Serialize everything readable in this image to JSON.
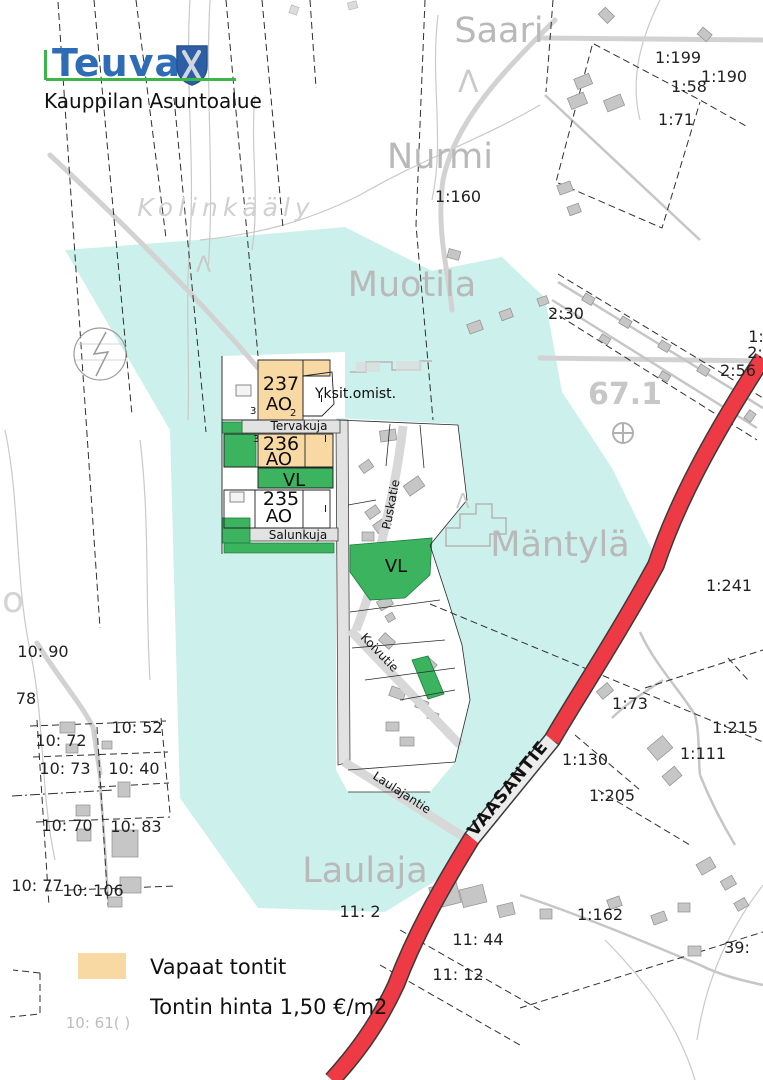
{
  "colors": {
    "highlight_cyan": "#ccf0ec",
    "vacant_orange": "#f8d9a4",
    "park_green": "#3cb45f",
    "road_red": "#ed3a44",
    "logo_blue": "#2e6db6",
    "logo_green": "#3db54a"
  },
  "header": {
    "municipality": "Teuva",
    "title": "Kauppilan Asuntoalue"
  },
  "legend": {
    "vacant_label": "Vapaat tontit",
    "price_label": "Tontin hinta 1,50 €/m2"
  },
  "map": {
    "places": {
      "saari": "Saari",
      "nurmi": "Nurmi",
      "kolinkaaly": "Kolinkääly",
      "muotila": "Muotila",
      "mantyla": "Mäntylä",
      "laulaja": "Laulaja",
      "block_67": "67.1",
      "letter_o": "o"
    },
    "symbols": {
      "lambda": "Λ"
    },
    "streets": {
      "tervakuja": "Tervakuja",
      "salunkuja": "Salunkuja",
      "puskatie": "Puskatie",
      "koivutie": "Koivutie",
      "laulajantie": "Laulajantie",
      "vaasantie": "VAASANTIE"
    },
    "plots": {
      "p237": "237",
      "p236": "236",
      "p235": "235",
      "ao": "AO",
      "vl": "VL",
      "yksit": "Yksit.omist.",
      "m3": "3",
      "m2": "2",
      "m1": "I"
    },
    "parcels": {
      "a1_199": "1:199",
      "a1_58": "1:58",
      "a1_190": "1:190",
      "a1_71": "1:71",
      "a1_160": "1:160",
      "a2_30": "2:30",
      "a2_56": "2:56",
      "a1_241": "1:241",
      "a1_215": "1:215",
      "a1_111": "1:111",
      "a1_73": "1:73",
      "a1_130": "1:130",
      "a1_205": "1:205",
      "a1_162": "1:162",
      "a39": "39:",
      "a1_part": "1:",
      "a2_part": "2:",
      "a10_90": "10: 90",
      "a78": "78",
      "a10_72": "10: 72",
      "a10_52": "10: 52",
      "a10_73": "10: 73",
      "a10_40": "10: 40",
      "a10_70": "10: 70",
      "a10_83": "10: 83",
      "a10_77": "10: 77",
      "a10_106": "10: 106",
      "a11_2": "11: 2",
      "a11_44": "11: 44",
      "a11_12": "11: 12",
      "a10_61": "10: 61( )"
    }
  }
}
